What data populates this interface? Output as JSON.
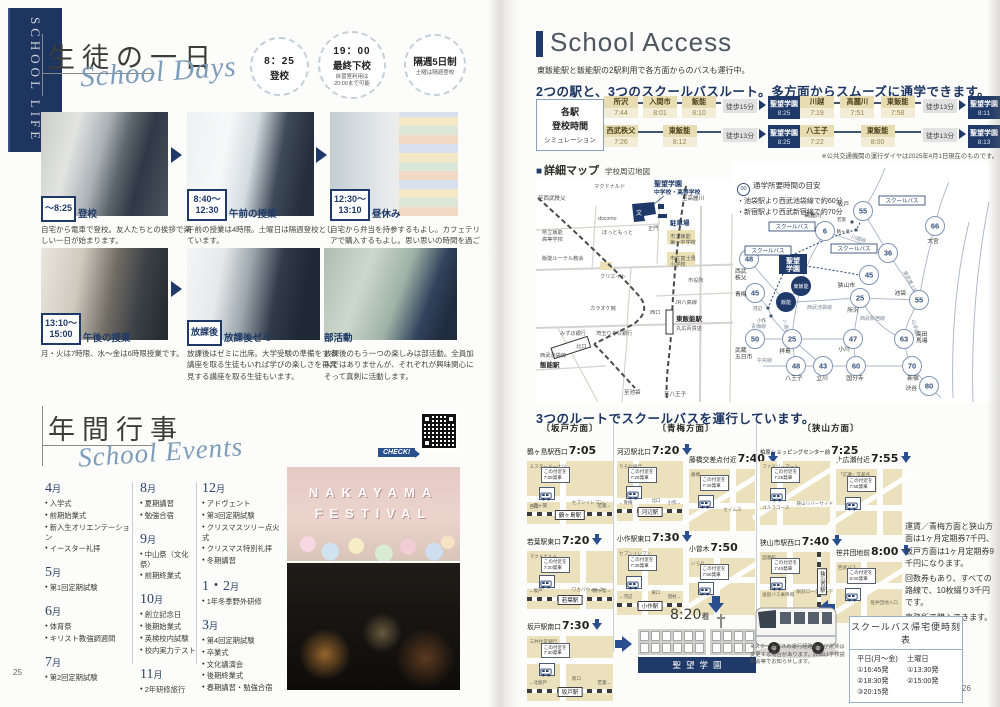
{
  "page_left": {
    "banner": "SCHOOL LIFE",
    "page_number": "25",
    "daily": {
      "title": "生徒の一日",
      "subtitle": "School Days",
      "badges": [
        {
          "l1": "8：25",
          "l2": "登校",
          "note": ""
        },
        {
          "l1": "19：00",
          "l2": "最終下校",
          "note": "自習室利用は\n20:00まで可能"
        },
        {
          "l1": "",
          "l2": "隔週5日制",
          "note": "土曜は隔週登校"
        }
      ],
      "items": [
        {
          "t": "～8:25",
          "t2": "",
          "label": "登校",
          "desc": "自宅から電車で登校。友人たちとの挨拶で楽しい一日が始まります。"
        },
        {
          "t": "8:40～",
          "t2": "12:30",
          "label": "午前の授業",
          "desc": "午前の授業は4時限。土曜日は隔週登校としています。"
        },
        {
          "t": "12:30～",
          "t2": "13:10",
          "label": "昼休み",
          "desc": "自宅から弁当を持参するもよし。カフェテリアで購入するもよし。思い思いの時間を過ごします。"
        },
        {
          "t": "13:10～",
          "t2": "15:00",
          "label": "午後の授業",
          "desc": "月・火は7時限、水～金は6時限授業です。"
        },
        {
          "t": "放課後",
          "t2": "",
          "label": "放課後ゼミ",
          "desc": "放課後はゼミに出席。大学受験の準備をする講座を取る生徒もいれば学びの楽しさを再発見する講座を取る生徒もいます。"
        },
        {
          "t": "",
          "t2": "",
          "label": "部活動",
          "desc": "放課後のもう一つの楽しみは部活動。全員加入ではありませんが、それぞれが興味関心にそって真剣に活動します。"
        }
      ]
    },
    "events": {
      "title": "年間行事",
      "subtitle": "School Events",
      "check_label": "CHECK!",
      "festival": {
        "line1": "NAKAYAMA",
        "line2": "FESTIVAL"
      },
      "columns": [
        [
          {
            "m": "4",
            "items": [
              "入学式",
              "前期始業式",
              "新入生オリエンテーション",
              "イースター礼拝"
            ]
          },
          {
            "m": "5",
            "items": [
              "第1回定期試験"
            ]
          },
          {
            "m": "6",
            "items": [
              "体育祭",
              "キリスト教強調週間"
            ]
          },
          {
            "m": "7",
            "items": [
              "第2回定期試験"
            ]
          }
        ],
        [
          {
            "m": "8",
            "items": [
              "夏期講習",
              "勉強合宿"
            ]
          },
          {
            "m": "9",
            "items": [
              "中山祭（文化祭）",
              "前期終業式"
            ]
          },
          {
            "m": "10",
            "items": [
              "創立記念日",
              "後期始業式",
              "英検校内試験",
              "校内実力テスト"
            ]
          },
          {
            "m": "11",
            "items": [
              "2年研修旅行"
            ]
          }
        ],
        [
          {
            "m": "12",
            "items": [
              "アドヴェント",
              "第3回定期試験",
              "クリスマスツリー点火式",
              "クリスマス特別礼拝",
              "冬期講習"
            ]
          },
          {
            "m": "1・2",
            "items": [
              "1年冬季野外研修"
            ]
          },
          {
            "m": "3",
            "items": [
              "第4回定期試験",
              "卒業式",
              "文化講演会",
              "後期終業式",
              "春期講習・勉強合宿"
            ]
          }
        ]
      ],
      "month_unit": "月"
    }
  },
  "page_right": {
    "page_number": "26",
    "access": {
      "title": "School Access",
      "subtitle": "東飯能駅と飯能駅の2駅利用で各方面からのバスも運行中。",
      "headline": "2つの駅と、3つのスクールバスルート。多方面からスムーズに通学できます。",
      "sim_box": {
        "l1": "各駅",
        "l2": "登校時間",
        "l3": "シミュレーション"
      },
      "routes": [
        {
          "stations": [
            {
              "name": "所沢",
              "time": "7:44"
            },
            {
              "name": "入間市",
              "time": "8:01"
            },
            {
              "name": "飯能",
              "time": "8:10"
            }
          ],
          "walk": "徒歩15分",
          "dest": {
            "name": "聖望学園",
            "time": "8:25"
          }
        },
        {
          "stations": [
            {
              "name": "西武秩父",
              "time": "7:26"
            },
            {
              "name": "東飯能",
              "time": "8:12"
            }
          ],
          "walk": "徒歩13分",
          "dest": {
            "name": "聖望学園",
            "time": "8:25"
          }
        },
        {
          "stations": [
            {
              "name": "川越",
              "time": "7:19"
            },
            {
              "name": "高麗川",
              "time": "7:51"
            },
            {
              "name": "東飯能",
              "time": "7:58"
            }
          ],
          "walk": "徒歩13分",
          "dest": {
            "name": "聖望学園",
            "time": "8:11"
          }
        },
        {
          "stations": [
            {
              "name": "八王子",
              "time": "7:22"
            },
            {
              "name": "東飯能",
              "time": "8:00"
            }
          ],
          "walk": "徒歩13分",
          "dest": {
            "name": "聖望学園",
            "time": "8:13"
          }
        }
      ],
      "note": "※公共交通機関の運行ダイヤは2025年4月1日現在のものです。"
    },
    "detail_map": {
      "title": "詳細マップ",
      "subtitle": "学校周辺地図",
      "labels": [
        {
          "x": 2,
          "y": 22,
          "t": "至西武秩父",
          "c": "dm-dir"
        },
        {
          "x": 58,
          "y": 10,
          "t": "マクドナルド",
          "c": "dm-t"
        },
        {
          "x": 118,
          "y": 8,
          "t": "聖望学園",
          "c": "dm-nav"
        },
        {
          "x": 118,
          "y": 16,
          "t": "中学校・高等学校",
          "c": "dm-nav2"
        },
        {
          "x": 146,
          "y": 22,
          "t": "至高麗川",
          "c": "dm-dir"
        },
        {
          "x": 62,
          "y": 42,
          "t": "docomo",
          "c": "dm-t"
        },
        {
          "x": 134,
          "y": 47,
          "t": "駐車場",
          "c": "dm-park"
        },
        {
          "x": 112,
          "y": 52,
          "t": "正門",
          "c": "dm-t"
        },
        {
          "x": 66,
          "y": 56,
          "t": "ほっともっと",
          "c": "dm-t"
        },
        {
          "x": 6,
          "y": 56,
          "t": "県立飯能",
          "c": "dm-t"
        },
        {
          "x": 6,
          "y": 63,
          "t": "高等学校",
          "c": "dm-t"
        },
        {
          "x": 134,
          "y": 60,
          "t": "市立飯能",
          "c": "dm-t"
        },
        {
          "x": 134,
          "y": 66,
          "t": "第一中学校",
          "c": "dm-t"
        },
        {
          "x": 134,
          "y": 82,
          "t": "市立富士見",
          "c": "dm-t"
        },
        {
          "x": 134,
          "y": 88,
          "t": "小学校",
          "c": "dm-t"
        },
        {
          "x": 6,
          "y": 82,
          "t": "飯能ルーテル教会",
          "c": "dm-t"
        },
        {
          "x": 64,
          "y": 100,
          "t": "クリエイト",
          "c": "dm-t"
        },
        {
          "x": 152,
          "y": 104,
          "t": "市役所",
          "c": "dm-t"
        },
        {
          "x": 54,
          "y": 132,
          "t": "カラオケ館",
          "c": "dm-t"
        },
        {
          "x": 139,
          "y": 126,
          "t": "JR八高線",
          "c": "dm-t"
        },
        {
          "x": 114,
          "y": 136,
          "t": "西口",
          "c": "dm-t"
        },
        {
          "x": 140,
          "y": 143,
          "t": "東飯能駅",
          "c": "dm-b"
        },
        {
          "x": 140,
          "y": 152,
          "t": "丸広百貨店",
          "c": "dm-t"
        },
        {
          "x": 24,
          "y": 157,
          "t": "みずほ銀行",
          "c": "dm-t"
        },
        {
          "x": 60,
          "y": 157,
          "t": "埼玉りそな銀行",
          "c": "dm-t"
        },
        {
          "x": 40,
          "y": 170,
          "t": "北口",
          "c": "dm-t"
        },
        {
          "x": 4,
          "y": 179,
          "t": "西武池袋線",
          "c": "dm-t"
        },
        {
          "x": 4,
          "y": 189,
          "t": "飯能駅",
          "c": "dm-b"
        },
        {
          "x": 88,
          "y": 216,
          "t": "至池袋",
          "c": "dm-dir"
        },
        {
          "x": 128,
          "y": 218,
          "t": "至八王子",
          "c": "dm-dir"
        }
      ]
    },
    "wide_map": {
      "title": "広域アクセス",
      "subtitle": "学校最寄りまでの所要時間",
      "legend_circle": "00",
      "legend_title": "通学所要時間の目安",
      "legend_lines": [
        "・池袋駅より西武池袋線で約60分",
        "・新宿駅より西武新宿線で約70分"
      ],
      "school": {
        "l1": "聖望",
        "l2": "学園"
      },
      "bus_label": "スクールバス",
      "bus_boxes": [
        {
          "x": 146,
          "y": 34
        },
        {
          "x": 36,
          "y": 60
        },
        {
          "x": 98,
          "y": 82
        },
        {
          "x": 12,
          "y": 84
        }
      ],
      "hubs": [
        {
          "x": 68,
          "y": 124,
          "t": "東飯能"
        },
        {
          "x": 53,
          "y": 140,
          "t": "飯能"
        }
      ],
      "dots": [
        {
          "x": 119,
          "y": 60,
          "t": "若葉",
          "lx": 113,
          "ly": 59,
          "a": "end"
        },
        {
          "x": 123,
          "y": 68,
          "t": "鶴ヶ島",
          "lx": 117,
          "ly": 71,
          "a": "end"
        },
        {
          "x": 35,
          "y": 146,
          "t": "河辺",
          "lx": 29,
          "ly": 148,
          "a": "end"
        },
        {
          "x": 38,
          "y": 154,
          "t": "小作",
          "lx": 33,
          "ly": 160,
          "a": "end"
        }
      ],
      "nodes": [
        {
          "x": 130,
          "y": 49,
          "m": "55",
          "t": "坂戸",
          "lx": 116,
          "ly": 44,
          "a": "end"
        },
        {
          "x": 92,
          "y": 69,
          "m": "6",
          "t": "高麗川",
          "lx": 80,
          "ly": 55,
          "a": "middle"
        },
        {
          "x": 202,
          "y": 64,
          "m": "66",
          "t": "大宮",
          "lx": 200,
          "ly": 81,
          "a": "middle"
        },
        {
          "x": 155,
          "y": 91,
          "m": "36",
          "t": "川越",
          "lx": 141,
          "ly": 87,
          "a": "end"
        },
        {
          "x": 136,
          "y": 113,
          "m": "45",
          "t": "狭山市",
          "lx": 122,
          "ly": 125,
          "a": "end"
        },
        {
          "x": 16,
          "y": 97,
          "m": "48",
          "t": "西武",
          "t2": "秩父",
          "lx": 2,
          "ly": 111,
          "a": "start"
        },
        {
          "x": 22,
          "y": 131,
          "m": "45",
          "t": "青梅",
          "lx": 2,
          "ly": 134,
          "a": "start"
        },
        {
          "x": 186,
          "y": 138,
          "m": "55",
          "t": "池袋",
          "lx": 173,
          "ly": 133,
          "a": "end"
        },
        {
          "x": 127,
          "y": 136,
          "m": "25",
          "t": "所沢",
          "lx": 120,
          "ly": 150,
          "a": "middle"
        },
        {
          "x": 171,
          "y": 177,
          "m": "63",
          "t": "高田",
          "t2": "馬場",
          "lx": 183,
          "ly": 174,
          "a": "start"
        },
        {
          "x": 22,
          "y": 177,
          "m": "50",
          "t": "武蔵",
          "t2": "五日市",
          "lx": 2,
          "ly": 190,
          "a": "start"
        },
        {
          "x": 59,
          "y": 177,
          "m": "25",
          "t": "拝島",
          "lx": 52,
          "ly": 191,
          "a": "middle"
        },
        {
          "x": 120,
          "y": 177,
          "m": "47",
          "t": "小川",
          "lx": 111,
          "ly": 189,
          "a": "middle"
        },
        {
          "x": 63,
          "y": 204,
          "m": "48",
          "t": "八王子",
          "lx": 61,
          "ly": 218,
          "a": "middle"
        },
        {
          "x": 90,
          "y": 204,
          "m": "43",
          "t": "立川",
          "lx": 89,
          "ly": 218,
          "a": "middle"
        },
        {
          "x": 123,
          "y": 204,
          "m": "60",
          "t": "国分寺",
          "lx": 122,
          "ly": 218,
          "a": "middle"
        },
        {
          "x": 179,
          "y": 204,
          "m": "70",
          "t": "新宿",
          "lx": 180,
          "ly": 218,
          "a": "middle"
        },
        {
          "x": 196,
          "y": 224,
          "m": "80",
          "t": "渋谷",
          "lx": 184,
          "ly": 228,
          "a": "end"
        }
      ],
      "line_labels": [
        {
          "x": 118,
          "y": 76,
          "t": "川越線",
          "r": 18
        },
        {
          "x": 170,
          "y": 110,
          "t": "東武東上線",
          "r": 62
        },
        {
          "x": 74,
          "y": 147,
          "t": "西武池袋線",
          "r": 0
        },
        {
          "x": 50,
          "y": 158,
          "t": "八高線",
          "r": 78
        },
        {
          "x": 18,
          "y": 166,
          "t": "青梅線",
          "r": 0
        },
        {
          "x": 127,
          "y": 158,
          "t": "西武新宿線",
          "r": 0
        },
        {
          "x": 179,
          "y": 158,
          "t": "山手線",
          "r": 78
        },
        {
          "x": 24,
          "y": 200,
          "t": "中央線",
          "r": 0
        }
      ]
    },
    "bus_routes": {
      "headline": "3つのルートでスクールバスを運行しています。",
      "note_prefix": "この付近を",
      "note_suffix": "発車",
      "groups": [
        {
          "name": "〔坂戸方面〕",
          "cols": [
            [
              {
                "name": "鶴ヶ島駅西口",
                "time": "7:05",
                "station": "鶴ヶ島駅",
                "left": "←霞ヶ関",
                "right": "若葉→",
                "labels": [
                  "ミスタードーナツ",
                  "セブンイレブン",
                  "西口"
                ],
                "arrow": false
              },
              {
                "name": "若葉駅東口",
                "time": "7:20",
                "station": "若葉駅",
                "left": "←坂戸",
                "right": "鶴ヶ島→",
                "labels": [
                  "マクドナルド",
                  "ワカバウォーク"
                ],
                "arrow": true
              },
              {
                "name": "坂戸駅南口",
                "time": "7:30",
                "station": "坂戸駅",
                "left": "←北坂戸",
                "right": "若葉→",
                "labels": [
                  "三井住友銀行",
                  "南口"
                ],
                "arrow": true
              }
            ]
          ]
        },
        {
          "name": "〔青梅方面〕",
          "cols": [
            [
              {
                "name": "河辺駅北口",
                "time": "7:20",
                "station": "河辺駅",
                "left": "←青梅",
                "right": "小作→",
                "labels": [
                  "りそな銀行",
                  "北口"
                ],
                "arrow": true
              },
              {
                "name": "小作駅東口",
                "time": "7:30",
                "station": "小作駅",
                "left": "←河辺",
                "right": "羽村→",
                "labels": [
                  "セブンイレブン",
                  "東口"
                ],
                "arrow": true
              }
            ],
            [
              {
                "name": "藤橋交差点付近",
                "time": "7:40",
                "labels": [
                  "藤橋",
                  "セイムス"
                ],
                "arrow": true
              },
              {
                "name": "小曾木",
                "time": "7:50",
                "labels": [
                  "いろり"
                ],
                "arrow": false
              }
            ]
          ]
        },
        {
          "name": "〔狭山方面〕",
          "cols": [
            [
              {
                "name": "柏原ショッピングセンター前",
                "time": "7:25",
                "labels": [
                  "ファミリーマート",
                  "狭山リバーサイド",
                  "ゴルフコース"
                ],
                "arrow": false
              },
              {
                "name": "狭山市駅西口",
                "time": "7:40",
                "station": "狭山市駅",
                "vertical": true,
                "labels": [
                  "図書館",
                  "駅前ロータリー下",
                  "送迎バス乗降場"
                ],
                "arrow": true
              }
            ],
            [
              {
                "name": "上広瀬付近",
                "time": "7:55",
                "labels": [
                  "「広瀬」交差点"
                ],
                "arrow": true
              },
              {
                "name": "笹井団地前",
                "time": "8:00",
                "labels": [
                  "西武バス",
                  "笹井団地入口"
                ],
                "arrow": true
              }
            ]
          ]
        }
      ],
      "arrival": "8:20",
      "arrival_suffix": "着",
      "school_band": "聖望学園",
      "fare_lines": [
        "運賃／青梅方面と狭山方面は1ヶ月定期券7千円、坂戸方面は1ヶ月定期券9千円になります。",
        "回数券もあり、すべての路線で、10枚綴り3千円です。",
        "事務所で購入できます。"
      ],
      "bus_note": "※スクールバスの運行経路および運賃は変更する場合があります。詳細は学校説明会等でお知らせします。",
      "timetable": {
        "title": "スクールバス帰宅便時刻表",
        "weekday_label": "平日(月～金)",
        "weekday": [
          "①16:45発",
          "②18:30発",
          "③20:15発"
        ],
        "saturday_label": "土曜日",
        "saturday": [
          "①13:30発",
          "②15:00発"
        ]
      }
    }
  }
}
